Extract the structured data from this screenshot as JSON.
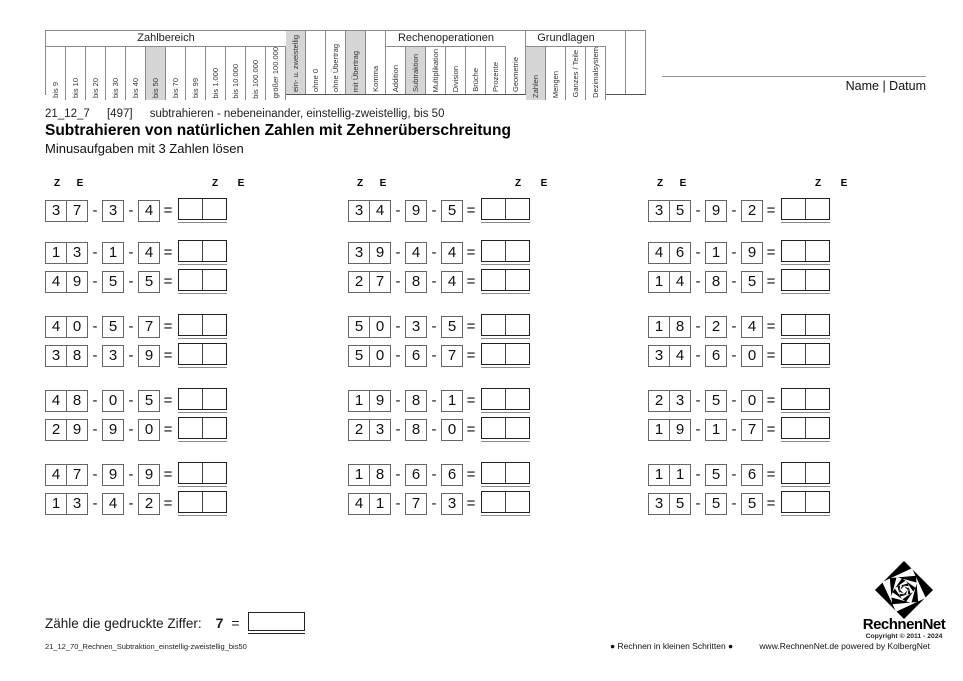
{
  "header_table": {
    "segments": [
      {
        "title": "Zahlbereich",
        "cols": [
          {
            "label": "bis 9"
          },
          {
            "label": "bis 10"
          },
          {
            "label": "bis 20"
          },
          {
            "label": "bis 30"
          },
          {
            "label": "bis 40"
          },
          {
            "label": "bis 50",
            "hl": true
          },
          {
            "label": "bis 70"
          },
          {
            "label": "bis 99"
          },
          {
            "label": "bis 1.000"
          },
          {
            "label": "bis 10.000"
          },
          {
            "label": "bis 100.000"
          },
          {
            "label": "größer 100.000"
          }
        ]
      },
      {
        "title": null,
        "cols": [
          {
            "label": "ein- u. zweistellig",
            "hl": true
          },
          {
            "label": "ohne 0"
          },
          {
            "label": "ohne Übertrag"
          },
          {
            "label": "mit Übertrag",
            "hl": true
          },
          {
            "label": "Komma"
          }
        ]
      },
      {
        "title": "Rechenoperationen",
        "cols": [
          {
            "label": "Addition"
          },
          {
            "label": "Subtraktion",
            "hl": true
          },
          {
            "label": "Multiplikation"
          },
          {
            "label": "Division"
          },
          {
            "label": "Brüche"
          },
          {
            "label": "Prozente"
          }
        ]
      },
      {
        "title": null,
        "cols": [
          {
            "label": "Geometrie"
          }
        ]
      },
      {
        "title": "Grundlagen",
        "cols": [
          {
            "label": "Zahlen",
            "hl": true
          },
          {
            "label": "Mengen"
          },
          {
            "label": "Ganzes / Teile"
          },
          {
            "label": "Dezimalsystem"
          }
        ]
      },
      {
        "title": null,
        "cols": [
          {
            "label": ""
          },
          {
            "label": ""
          }
        ]
      }
    ]
  },
  "name_datum_label": "Name | Datum",
  "meta": {
    "code": "21_12_7",
    "id": "[497]",
    "desc": "subtrahieren - nebeneinander, einstellig-zweistellig, bis 50"
  },
  "title": "Subtrahieren von natürlichen Zahlen mit Zehnerüberschreitung",
  "subtitle": "Minusaufgaben mit 3 Zahlen lösen",
  "ze": {
    "tens": "Z",
    "ones": "E"
  },
  "operators": {
    "minus": "-",
    "equals": "="
  },
  "problems": {
    "columns": [
      [
        [
          "3",
          "7",
          "3",
          "4"
        ],
        [
          "1",
          "3",
          "1",
          "4"
        ],
        [
          "4",
          "9",
          "5",
          "5"
        ],
        [
          "4",
          "0",
          "5",
          "7"
        ],
        [
          "3",
          "8",
          "3",
          "9"
        ],
        [
          "4",
          "8",
          "0",
          "5"
        ],
        [
          "2",
          "9",
          "9",
          "0"
        ],
        [
          "4",
          "7",
          "9",
          "9"
        ],
        [
          "1",
          "3",
          "4",
          "2"
        ]
      ],
      [
        [
          "3",
          "4",
          "9",
          "5"
        ],
        [
          "3",
          "9",
          "4",
          "4"
        ],
        [
          "2",
          "7",
          "8",
          "4"
        ],
        [
          "5",
          "0",
          "3",
          "5"
        ],
        [
          "5",
          "0",
          "6",
          "7"
        ],
        [
          "1",
          "9",
          "8",
          "1"
        ],
        [
          "2",
          "3",
          "8",
          "0"
        ],
        [
          "1",
          "8",
          "6",
          "6"
        ],
        [
          "4",
          "1",
          "7",
          "3"
        ]
      ],
      [
        [
          "3",
          "5",
          "9",
          "2"
        ],
        [
          "4",
          "6",
          "1",
          "9"
        ],
        [
          "1",
          "4",
          "8",
          "5"
        ],
        [
          "1",
          "8",
          "2",
          "4"
        ],
        [
          "3",
          "4",
          "6",
          "0"
        ],
        [
          "2",
          "3",
          "5",
          "0"
        ],
        [
          "1",
          "9",
          "1",
          "7"
        ],
        [
          "1",
          "1",
          "5",
          "6"
        ],
        [
          "3",
          "5",
          "5",
          "5"
        ]
      ]
    ]
  },
  "count_task": {
    "label": "Zähle die gedruckte Ziffer:",
    "digit": "7",
    "equals": "="
  },
  "footer": {
    "filename": "21_12_70_Rechnen_Subtraktion_einstellig-zweistellig_bis50",
    "slogan": "● Rechnen in kleinen Schritten ●",
    "site": "www.RechnenNet.de powered by KolbergNet",
    "logo_name": "RechnenNet",
    "copyright": "Copyright © 2011 - 2024"
  }
}
